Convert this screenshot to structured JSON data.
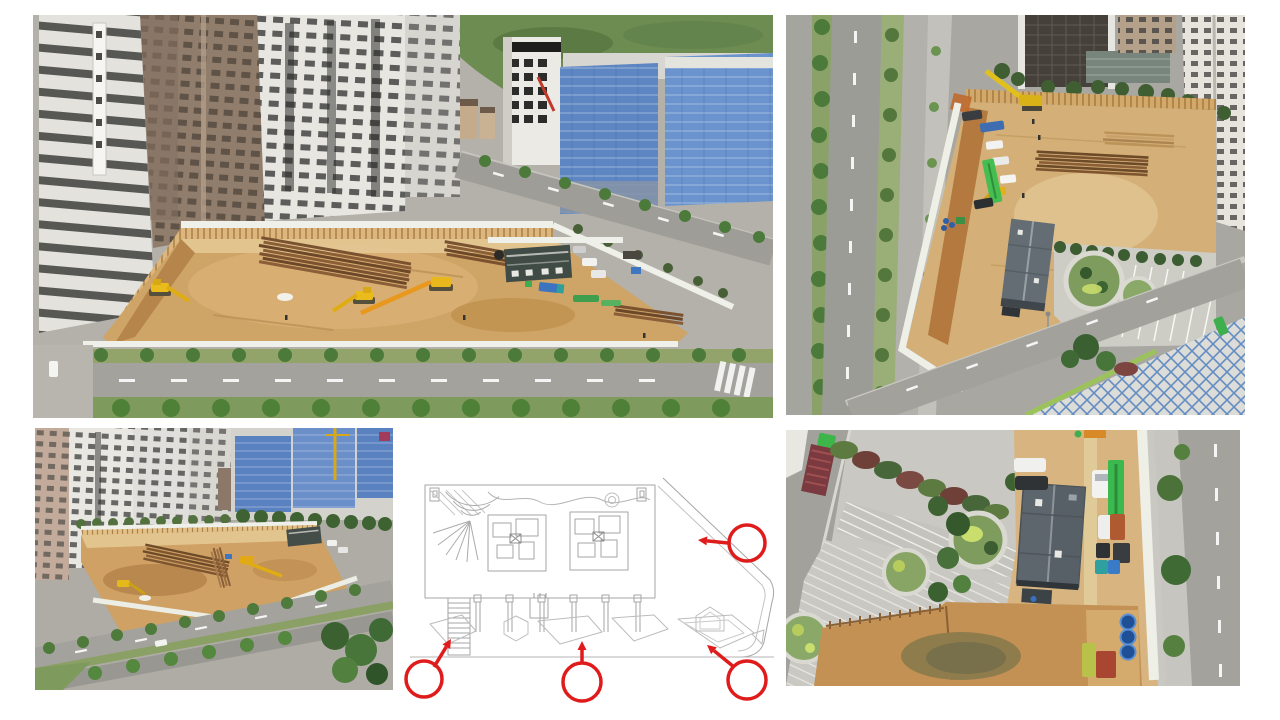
{
  "slide": {
    "background": "#ffffff",
    "description": "Collage of four aerial drone photos of a building-excavation construction site plus one grey-line architectural site plan annotated with four red circle call-outs and arrows"
  },
  "panels": [
    {
      "id": "photo-top-left",
      "type": "aerial-photo",
      "alt": "Oblique aerial view: excavation pit with soil, pile stacks and yellow excavators beside residential towers, a white office tower, blue-netted buildings under construction and a tree-lined road"
    },
    {
      "id": "photo-top-right",
      "type": "aerial-photo",
      "alt": "High aerial view: fenced excavation site and machinery yard with site office, circular landscaped garden, parked works vehicles and a multi-lane avenue on the left"
    },
    {
      "id": "photo-bottom-left",
      "type": "aerial-photo",
      "alt": "Wide oblique aerial view: excavation pit between white towers and blue-netted construction blocks with tower crane, boulevard with tree rows in front"
    },
    {
      "id": "site-plan",
      "type": "plan-drawing",
      "alt": "Ground floor site plan in light grey linework with fan stair, two unit cores, colonnade and paved walkway, marked with four red circles and arrows"
    },
    {
      "id": "photo-bottom-right",
      "type": "aerial-photo",
      "alt": "Top-down aerial view: gabled site-office roof, column of parked works vehicles, three blue water tanks, hatched parking bays, circular gardens and perimeter roads"
    }
  ],
  "plan_annotations": {
    "color": "#e01b1b",
    "stroke_width": 3.5,
    "circles": [
      {
        "id": "marker-bottom-left",
        "cx": 24,
        "cy": 249,
        "r": 18
      },
      {
        "id": "marker-bottom-center",
        "cx": 182,
        "cy": 252,
        "r": 19
      },
      {
        "id": "marker-bottom-right",
        "cx": 347,
        "cy": 250,
        "r": 19
      },
      {
        "id": "marker-top-right",
        "cx": 347,
        "cy": 113,
        "r": 18
      }
    ],
    "arrows": [
      {
        "id": "arrow-bottom-left",
        "from": [
          34,
          237
        ],
        "to": [
          51,
          209
        ]
      },
      {
        "id": "arrow-bottom-center",
        "from": [
          182,
          234
        ],
        "to": [
          182,
          211
        ]
      },
      {
        "id": "arrow-bottom-right",
        "from": [
          334,
          237
        ],
        "to": [
          307,
          215
        ]
      },
      {
        "id": "arrow-top-right",
        "from": [
          328,
          113
        ],
        "to": [
          298,
          110
        ]
      }
    ]
  },
  "palette": {
    "annotation_red": "#e01b1b",
    "excavation_soil": "#cfa467",
    "sheet_pile_wall": "#dcb67c",
    "safety_net_blue": "#5d86c2",
    "road_asphalt": "#a3a29d",
    "tree_green": "#4c7a3a",
    "plan_linework": "#a6a6a6"
  }
}
